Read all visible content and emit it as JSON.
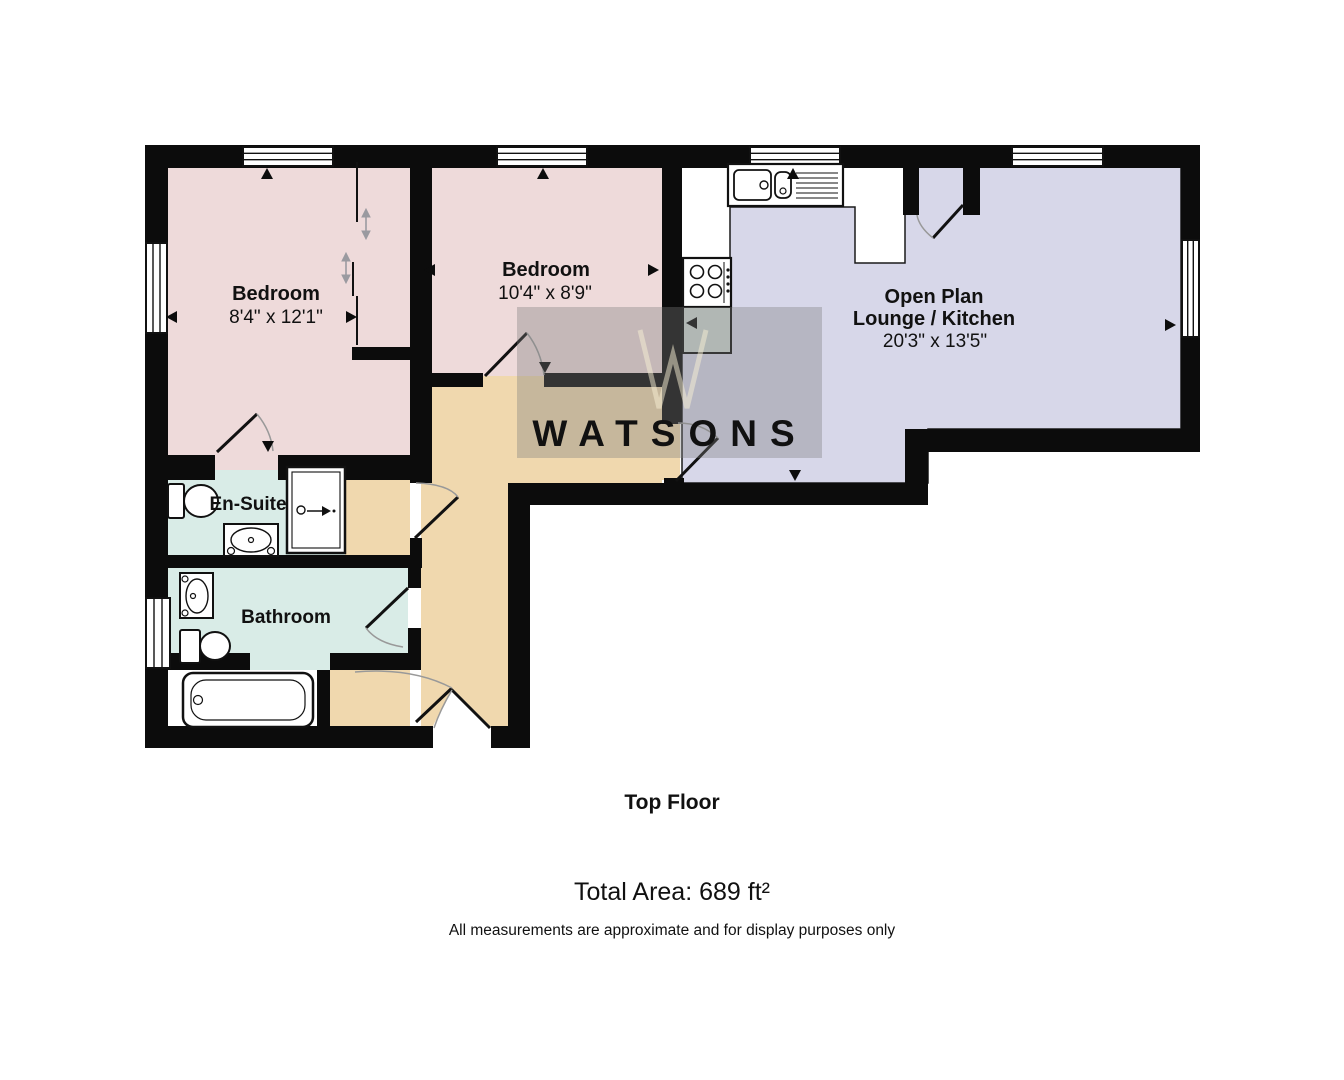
{
  "fp": {
    "rooms": {
      "bedroom1": {
        "name": "Bedroom",
        "dimensions": "8'4\" x 12'1\""
      },
      "bedroom2": {
        "name": "Bedroom",
        "dimensions": "10'4\" x 8'9\""
      },
      "open_plan": {
        "name_line1": "Open Plan",
        "name_line2": "Lounge / Kitchen",
        "dimensions": "20'3\" x 13'5\""
      },
      "ensuite": {
        "name": "En-Suite"
      },
      "bathroom": {
        "name": "Bathroom"
      }
    },
    "watermark": {
      "text": "WATSONS"
    },
    "footer": {
      "floor_label": "Top Floor",
      "total_area": "Total Area: 689 ft²",
      "disclaimer": "All measurements are approximate and for display purposes only"
    },
    "colors": {
      "bedroom_fill": "#eedada",
      "lounge_fill": "#d7d7e9",
      "hall_fill": "#f0d8ae",
      "bath_fill": "#d9ece7",
      "cabinet_fill": "#cfd8d4",
      "wall": "#0c0c0c",
      "watermark_overlay": "rgba(125,125,125,0.36)"
    }
  }
}
